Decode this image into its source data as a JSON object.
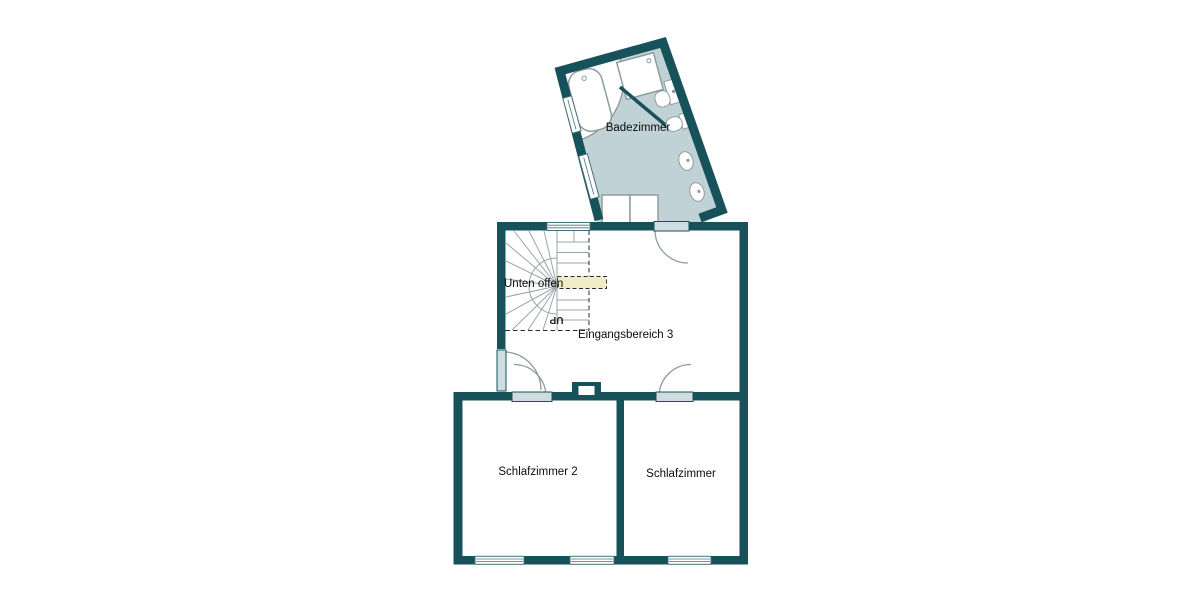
{
  "plan": {
    "type": "floor-plan",
    "rooms": [
      {
        "id": "badezimmer",
        "label": "Badezimmer"
      },
      {
        "id": "eingangsbereich-3",
        "label": "Eingangsbereich 3"
      },
      {
        "id": "schlafzimmer-2",
        "label": "Schlafzimmer 2"
      },
      {
        "id": "schlafzimmer",
        "label": "Schlafzimmer"
      }
    ],
    "stair": {
      "up_label": "UP",
      "open_below_label": "Unten offen"
    },
    "colors": {
      "wall": "#175159",
      "bathroom_floor": "#c1d2d6",
      "door_panel": "#cfdde0",
      "stair_tread_line": "#9aa5a6",
      "fixture_outline": "#8e9c9e",
      "open_below_band": "#f1ecc6",
      "label_text": "#0b0b0b",
      "background": "#ffffff"
    }
  }
}
